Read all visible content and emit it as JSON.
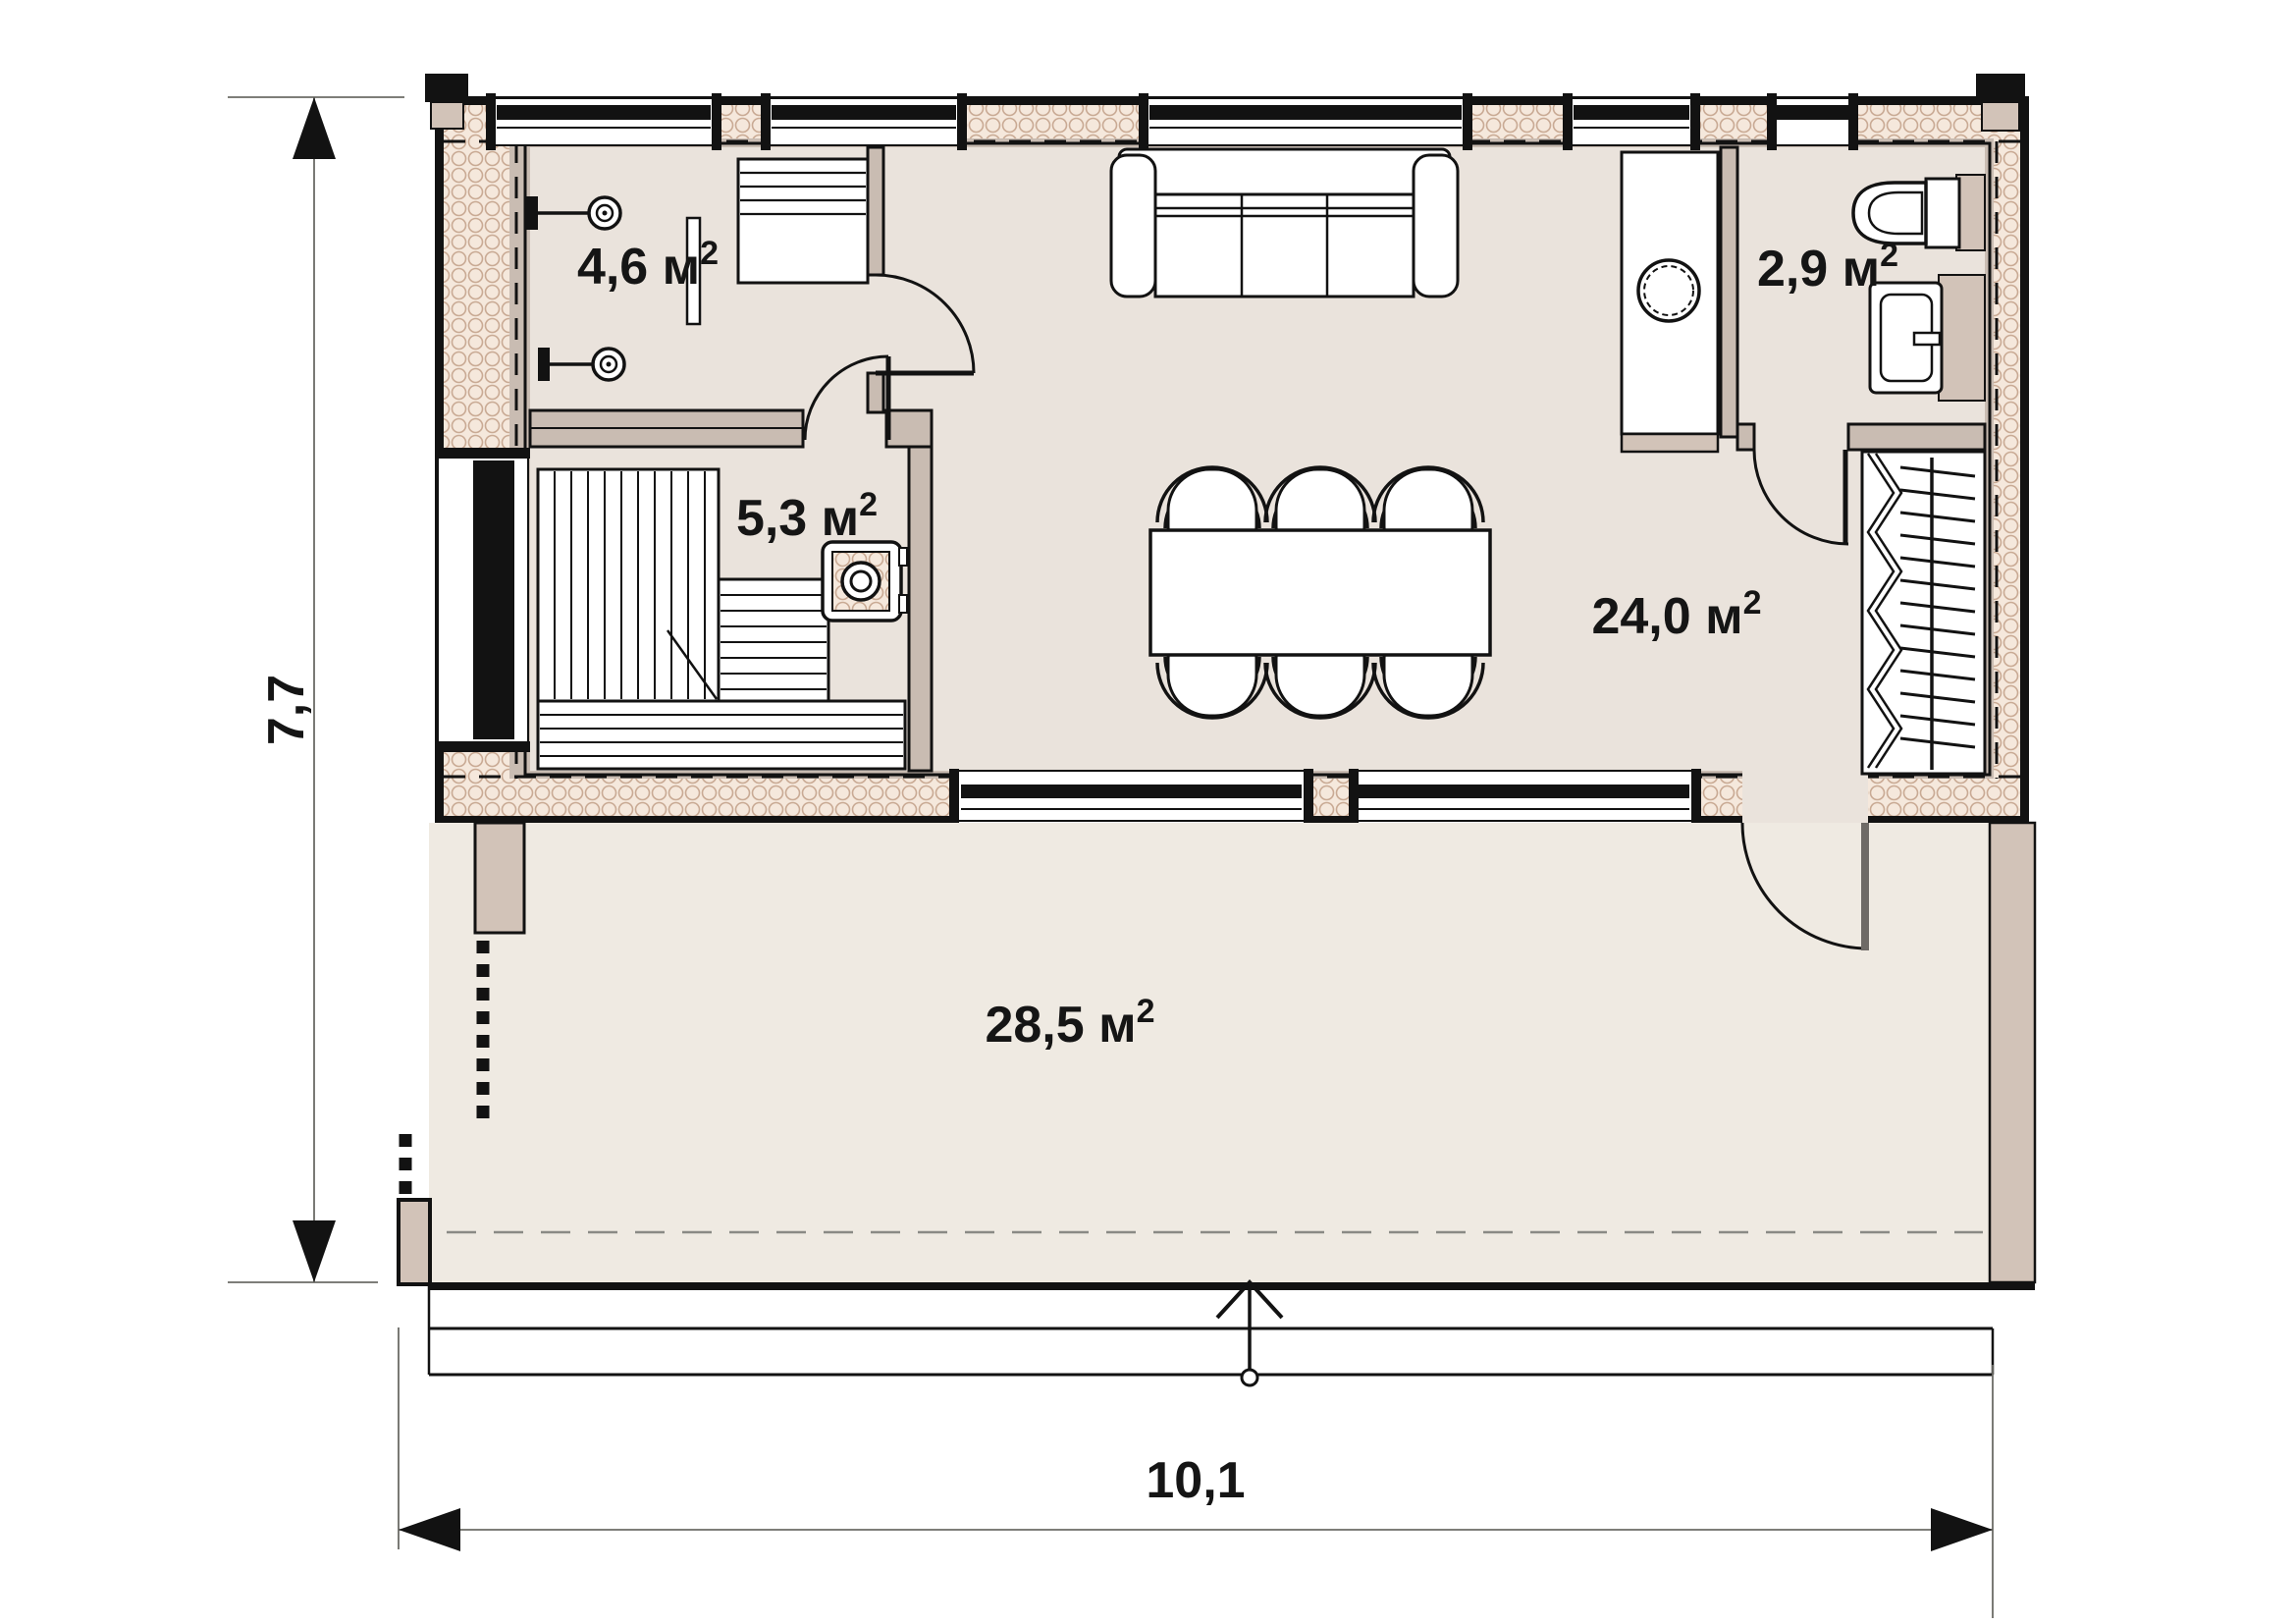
{
  "plan": {
    "rooms": [
      {
        "id": "shower",
        "area": "4,6 м",
        "sup": "2"
      },
      {
        "id": "sauna",
        "area": "5,3 м",
        "sup": "2"
      },
      {
        "id": "bathroom",
        "area": "2,9 м",
        "sup": "2"
      },
      {
        "id": "living-dining",
        "area": "24,0 м",
        "sup": "2"
      },
      {
        "id": "terrace",
        "area": "28,5 м",
        "sup": "2"
      }
    ],
    "dimensions": {
      "height_m": "7,7",
      "width_m": "10,1"
    },
    "colors": {
      "line": "#121212",
      "wall_insulation_fill": "#f5e8dc",
      "wall_insulation_hatch": "#c9aa94",
      "wall_inner_face": "#c9bcb2",
      "wood_trim": "#d2c3b8",
      "room_floor": "#eae3dc",
      "terrace_floor": "#efeae2"
    }
  }
}
